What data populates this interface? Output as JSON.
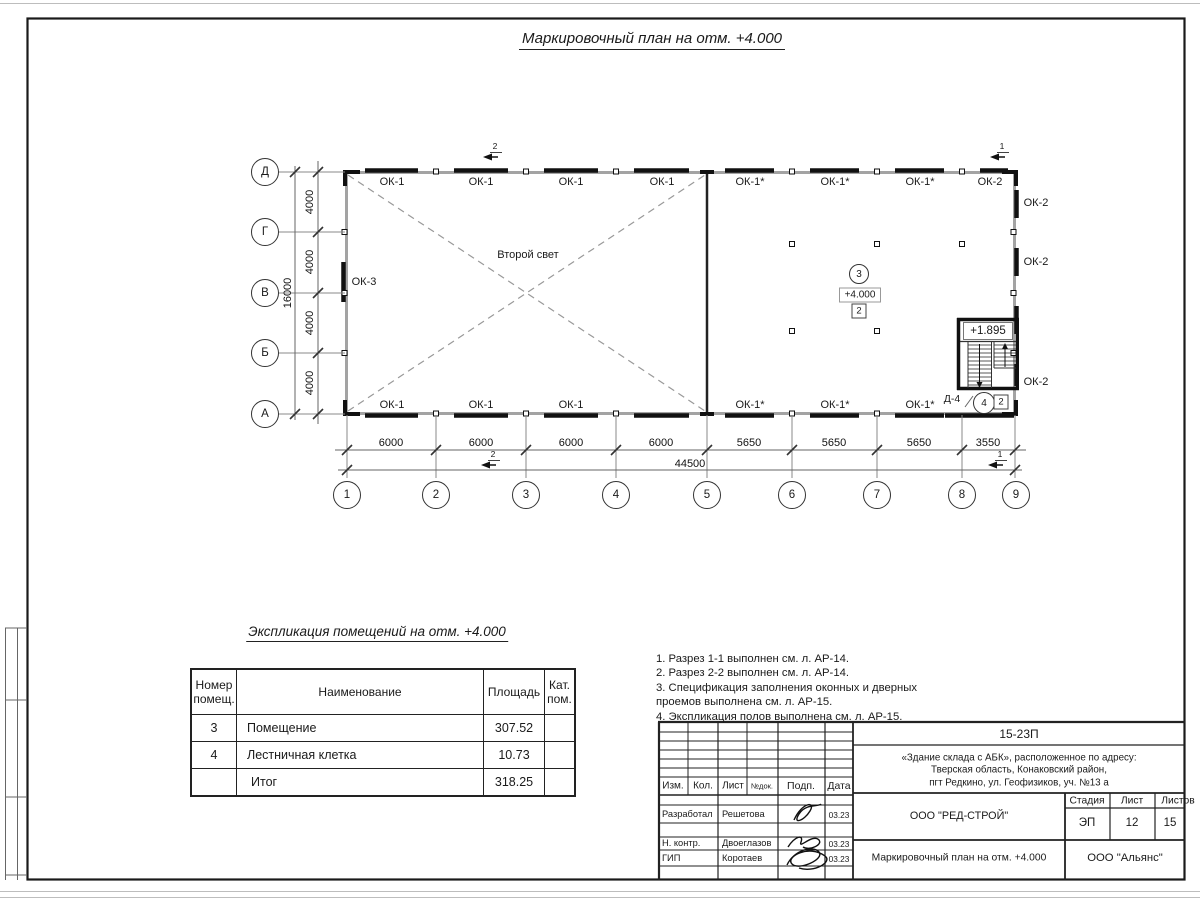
{
  "drawing_title": "Маркировочный план на отм. +4.000",
  "plan": {
    "second_light": "Второй свет",
    "axes_rows": [
      "Д",
      "Г",
      "В",
      "Б",
      "А"
    ],
    "axes_cols": [
      "1",
      "2",
      "3",
      "4",
      "5",
      "6",
      "7",
      "8",
      "9"
    ],
    "dims_bottom": [
      "6000",
      "6000",
      "6000",
      "6000",
      "5650",
      "5650",
      "5650",
      "3550"
    ],
    "dim_total_width": "44500",
    "dims_left": [
      "4000",
      "4000",
      "4000",
      "4000"
    ],
    "dim_total_height": "16000",
    "windows_top": [
      "ОК-1",
      "ОК-1",
      "ОК-1",
      "ОК-1",
      "ОК-1*",
      "ОК-1*",
      "ОК-1*",
      "ОК-2"
    ],
    "windows_bottom": [
      "ОК-1",
      "ОК-1",
      "ОК-1",
      "ОК-1*",
      "ОК-1*",
      "ОК-1*"
    ],
    "windows_right": [
      "ОК-2",
      "ОК-2",
      "ОК-2"
    ],
    "window_left": "ОК-3",
    "sections": {
      "s1": "1",
      "s2": "2"
    },
    "room": {
      "number": "3",
      "elevation": "+4.000",
      "category": "2"
    },
    "stair": {
      "number": "4",
      "category": "2",
      "door": "Д-4",
      "elevation": "+1.895"
    }
  },
  "explication": {
    "title": "Экспликация помещений на отм. +4.000",
    "headers": [
      "Номер помещ.",
      "Наименование",
      "Площадь",
      "Кат. пом."
    ],
    "rows": [
      [
        "3",
        "Помещение",
        "307.52",
        ""
      ],
      [
        "4",
        "Лестничная клетка",
        "10.73",
        ""
      ],
      [
        "",
        "Итог",
        "318.25",
        ""
      ]
    ]
  },
  "notes": {
    "lines": [
      "1. Разрез 1-1 выполнен см. л. АР-14.",
      "2. Разрез 2-2 выполнен см. л. АР-14.",
      "3. Спецификация заполнения оконных и дверных",
      "    проемов выполнена см. л. АР-15.",
      "4. Экспликация полов выполнена см. л. АР-15."
    ]
  },
  "stamp": {
    "doc_number": "15-23П",
    "object_address": [
      "«Здание склада с АБК», расположенное по адресу:",
      "Тверская область, Конаковский район,",
      "пгт Редкино, ул. Геофизиков, уч. №13 а"
    ],
    "cols": [
      "Изм.",
      "Кол.",
      "Лист",
      "№док.",
      "Подп.",
      "Дата"
    ],
    "rows": [
      {
        "role": "Разработал",
        "name": "Решетова",
        "date": "03.23"
      },
      {
        "role": "Н. контр.",
        "name": "Двоеглазов",
        "date": "03.23"
      },
      {
        "role": "ГИП",
        "name": "Коротаев",
        "date": "03.23"
      }
    ],
    "company": "ООО \"РЕД-СТРОЙ\"",
    "stage_label": "Стадия",
    "sheet_label": "Лист",
    "sheets_label": "Листов",
    "stage": "ЭП",
    "sheet": "12",
    "sheets": "15",
    "sheet_title": "Маркировочный план на отм. +4.000",
    "contractor": "ООО \"Альянс\""
  }
}
